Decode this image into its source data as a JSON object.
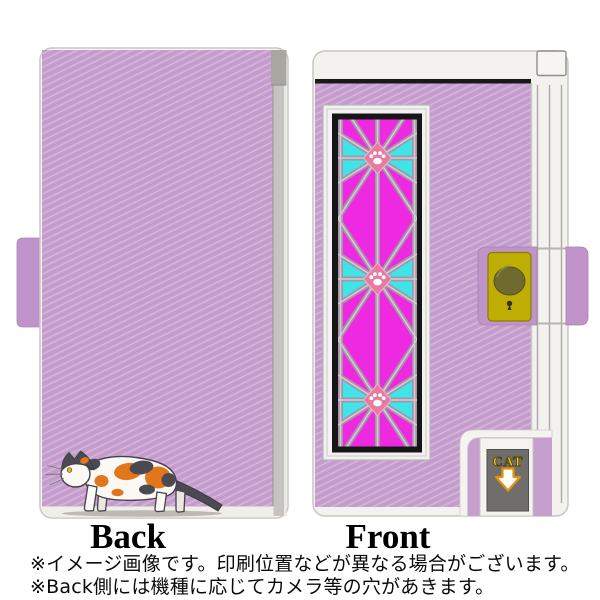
{
  "labels": {
    "back": "Back",
    "front": "Front",
    "cat_door": "CAT"
  },
  "captions": [
    "※イメージ画像です。印刷位置などが異なる場合がございます。",
    "※Back側には機種に応じてカメラ等の穴があきます。"
  ],
  "colors": {
    "case_purple": "#c79fcf",
    "case_purple_dark": "#c094ca",
    "glass_magenta": "#ef29e2",
    "glass_cyan": "#3de5e8",
    "lattice_gray": "#a496a4",
    "paw_pink": "#e87aa0",
    "clasp_plate_yellow": "#beae04",
    "knob_olive": "#6f6b2e",
    "door_panel_gray": "#6f6e6b",
    "cat_text_yellow": "#f2cf00",
    "arrow_orange": "#e6920a",
    "cat_orange": "#e1761c",
    "cat_dark_gray": "#4b4a52",
    "spine_gray": "#c6c3c0"
  }
}
